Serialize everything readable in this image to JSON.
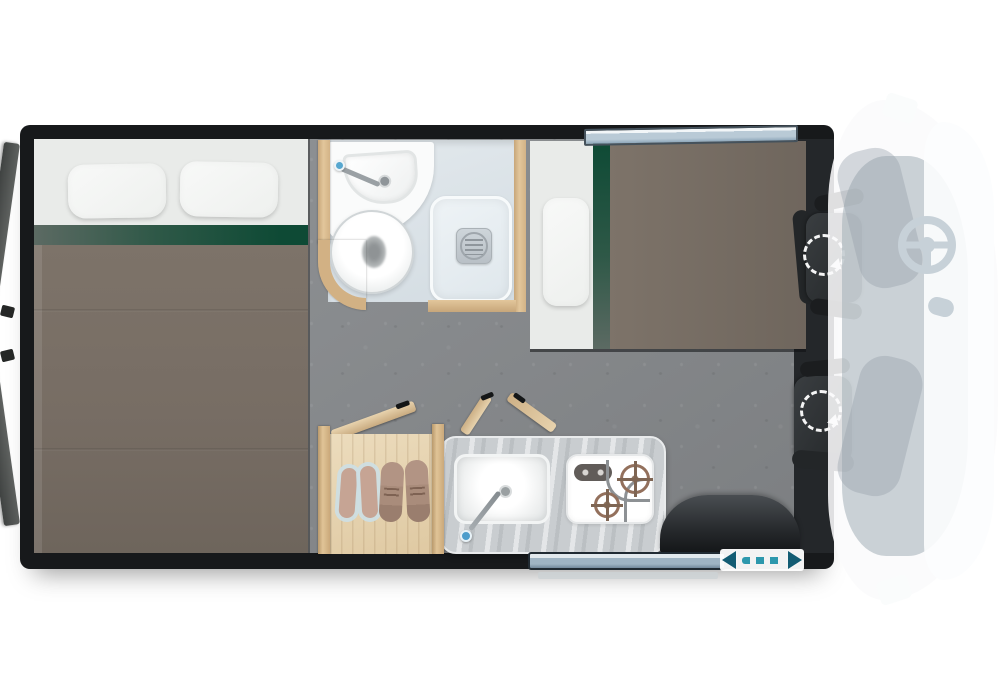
{
  "app": {
    "type": "vehicle-floorplan",
    "view": "top-down campervan layout"
  },
  "palette": {
    "wall": "#17191b",
    "floor": "#8a8d90",
    "bedding_blanket": "#7a7067",
    "bedding_sheet": "#e9ebe9",
    "accent_green": "#0e4a35",
    "wood": "#d9ba8e",
    "wood_light": "#e6d3b2",
    "bathroom_floor": "#dce4e9",
    "counter": "#c9cdd0",
    "window_glass": "#a9c0d2",
    "door_arrow_teal": "#135c73",
    "seat_dark": "#2b2e30",
    "cab_ghost": "#f4f6f7"
  },
  "areas": {
    "rear_bed": {
      "name": "Rear double bed",
      "pillow_count": 2,
      "accent_stripe": true
    },
    "bathroom": {
      "name": "Wet bathroom",
      "fixtures": [
        "washbasin",
        "faucet",
        "toilet",
        "shower-tray-with-drain"
      ]
    },
    "front_bed": {
      "name": "Front single bed",
      "pillow_count": 1,
      "window_above": true
    },
    "wardrobe": {
      "name": "Wardrobe shoe storage",
      "shoe_pairs": 2,
      "door_state": "open"
    },
    "kitchen": {
      "name": "Kitchenette",
      "fixtures": [
        "sink",
        "faucet",
        "two-burner-hob",
        "hob-knobs"
      ],
      "flap_doors_open": 2
    },
    "entry_door": {
      "name": "Sliding entry door",
      "indicator": "slide direction arrows"
    },
    "wheel_arch": {
      "name": "Rear wheel arch"
    },
    "rear_doors": {
      "name": "Rear barn doors",
      "count": 2,
      "state": "open"
    },
    "cab": {
      "name": "Driver cab ghosted",
      "seats": [
        "driver-swivel-seat",
        "passenger-swivel-seat"
      ],
      "features": [
        "steering-wheel",
        "gear-selector",
        "wing-mirrors"
      ],
      "swivel_indicators": 2
    }
  }
}
